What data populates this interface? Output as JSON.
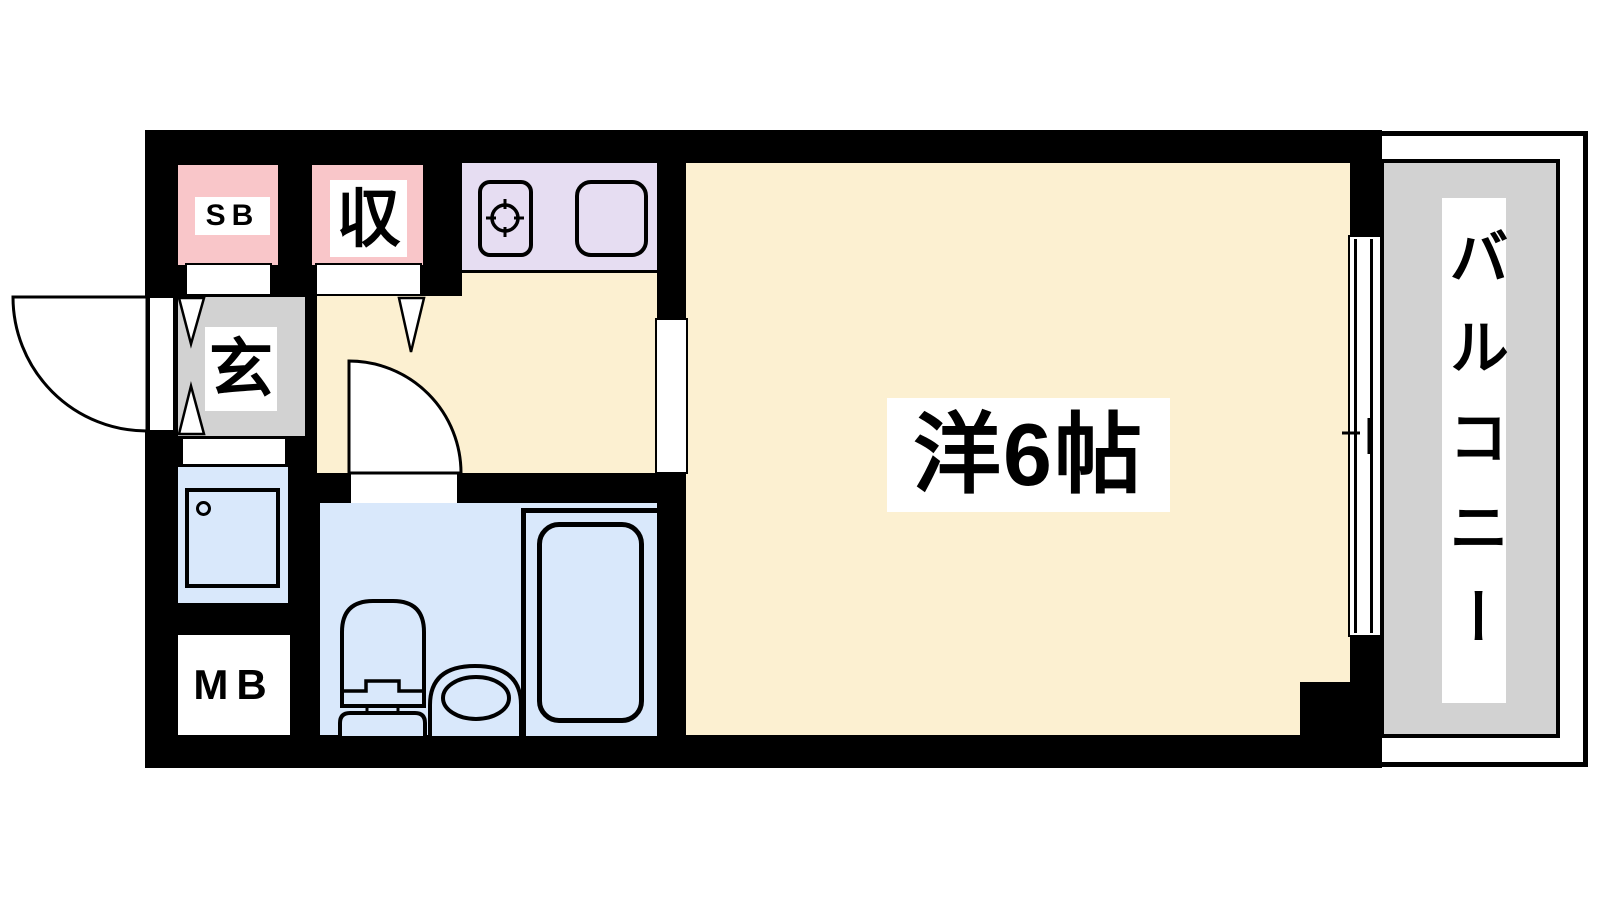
{
  "floorplan": {
    "type": "1K apartment floor plan",
    "labels": {
      "shoe_box": "SB",
      "closet": "収",
      "entrance": "玄",
      "meter_box": "MB",
      "main_room": "洋6帖",
      "balcony": "バルコニー"
    },
    "fixtures": {
      "kitchen": [
        "stove-burner",
        "sink"
      ],
      "bathroom": [
        "toilet",
        "bathtub"
      ],
      "utility": [
        "washing-machine-pan"
      ],
      "openings": [
        "entrance-swing-door",
        "hallway-swing-door",
        "room-door-opening",
        "sliding-window"
      ]
    },
    "colors": {
      "wall": "#000000",
      "floor_cream": "#fcf0d1",
      "storage_pink": "#f9c6c9",
      "kitchen_lavender": "#e6ddf2",
      "entrance_gray": "#d2d2d2",
      "wet_area_blue": "#d9e8fb",
      "balcony_gray": "#d2d2d2",
      "label_bg": "#ffffff"
    }
  }
}
